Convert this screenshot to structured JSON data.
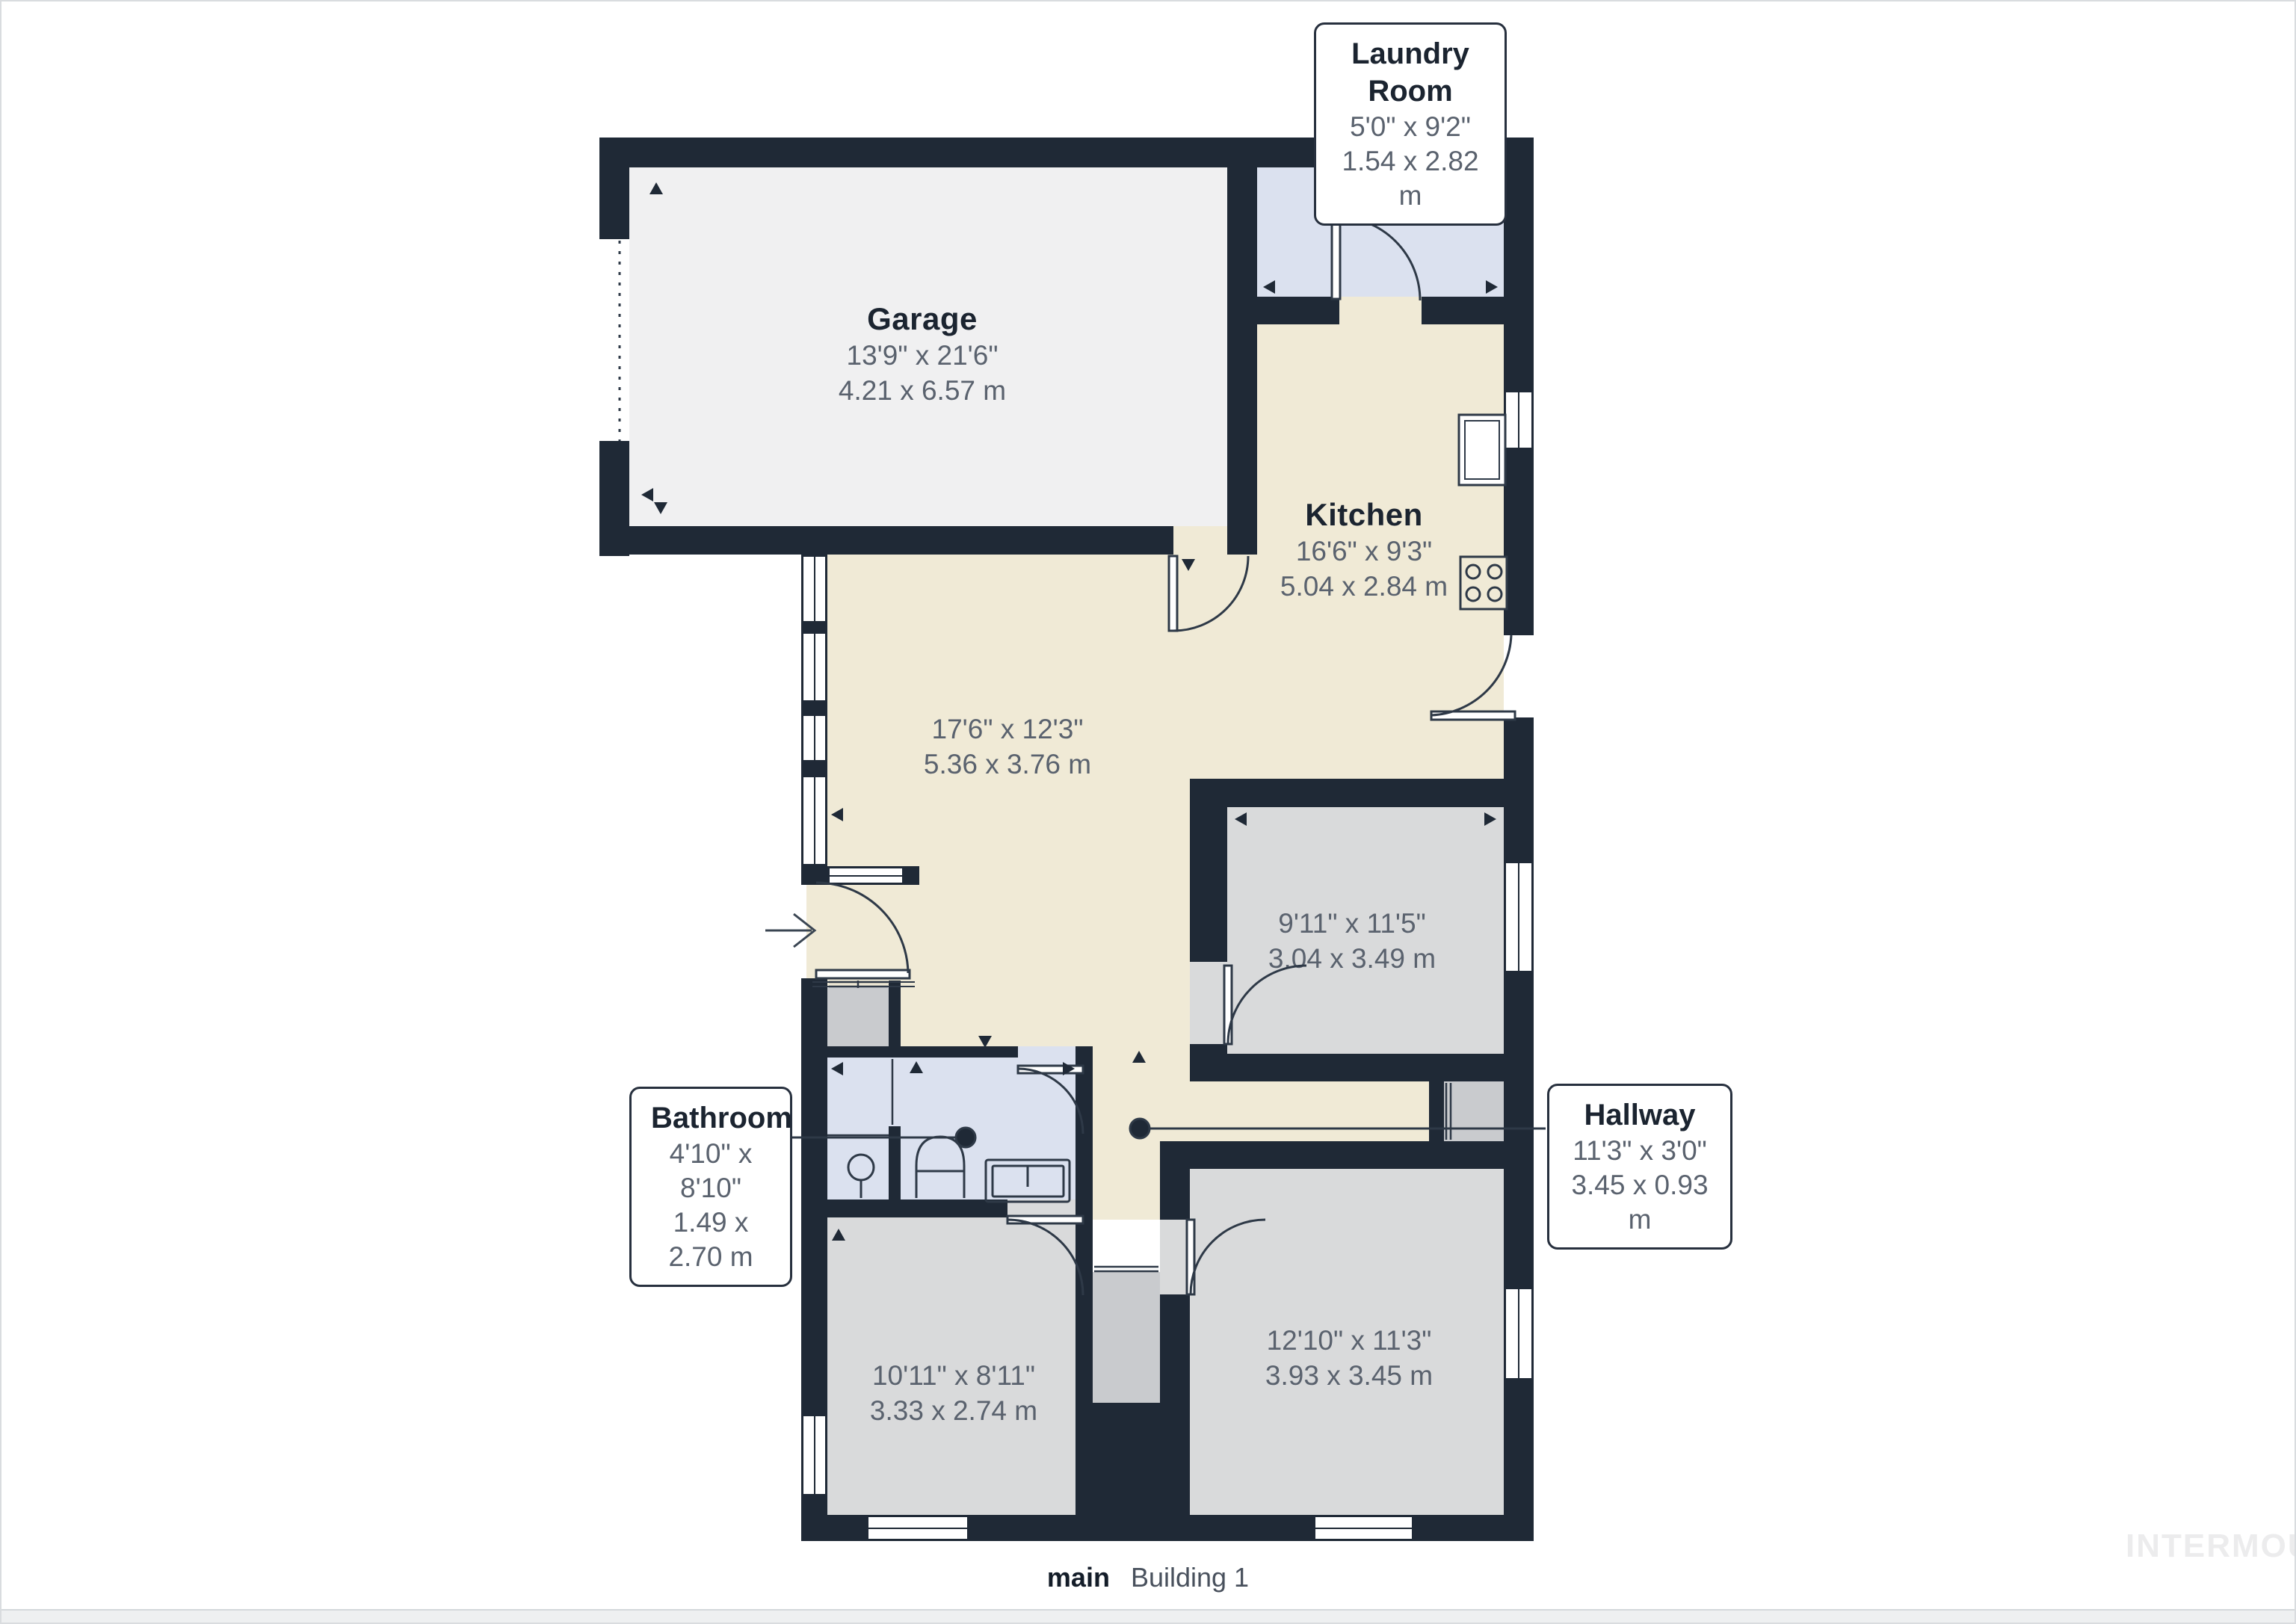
{
  "callouts": {
    "laundry": {
      "name": "Laundry Room",
      "dim_ft": "5'0\" x 9'2\"",
      "dim_m": "1.54 x 2.82 m"
    },
    "bathroom": {
      "name": "Bathroom",
      "dim_ft": "4'10\" x 8'10\"",
      "dim_m": "1.49 x 2.70 m"
    },
    "hallway": {
      "name": "Hallway",
      "dim_ft": "11'3\" x 3'0\"",
      "dim_m": "3.45 x 0.93 m"
    }
  },
  "rooms": {
    "garage": {
      "name": "Garage",
      "dim_ft": "13'9\" x 21'6\"",
      "dim_m": "4.21 x 6.57 m"
    },
    "kitchen": {
      "name": "Kitchen",
      "dim_ft": "16'6\" x 9'3\"",
      "dim_m": "5.04 x 2.84 m"
    },
    "living": {
      "dim_ft": "17'6\" x 12'3\"",
      "dim_m": "5.36 x 3.76 m"
    },
    "bedroom_right": {
      "dim_ft": "9'11\" x 11'5\"",
      "dim_m": "3.04 x 3.49 m"
    },
    "bedroom_bottom_left": {
      "dim_ft": "10'11\" x 8'11\"",
      "dim_m": "3.33 x 2.74 m"
    },
    "bedroom_bottom_right": {
      "dim_ft": "12'10\" x 11'3\"",
      "dim_m": "3.93 x 3.45 m"
    }
  },
  "footer": {
    "floor_label": "main",
    "building_label": "Building 1"
  },
  "watermark": "INTERMOUNTAIN",
  "colors": {
    "wall": "#1f2936",
    "beige": "#f0ead6",
    "grey_room": "#d9dadb",
    "garage": "#f0f0f1",
    "blue": "#dbe1ef",
    "closet": "#c9cbce"
  }
}
